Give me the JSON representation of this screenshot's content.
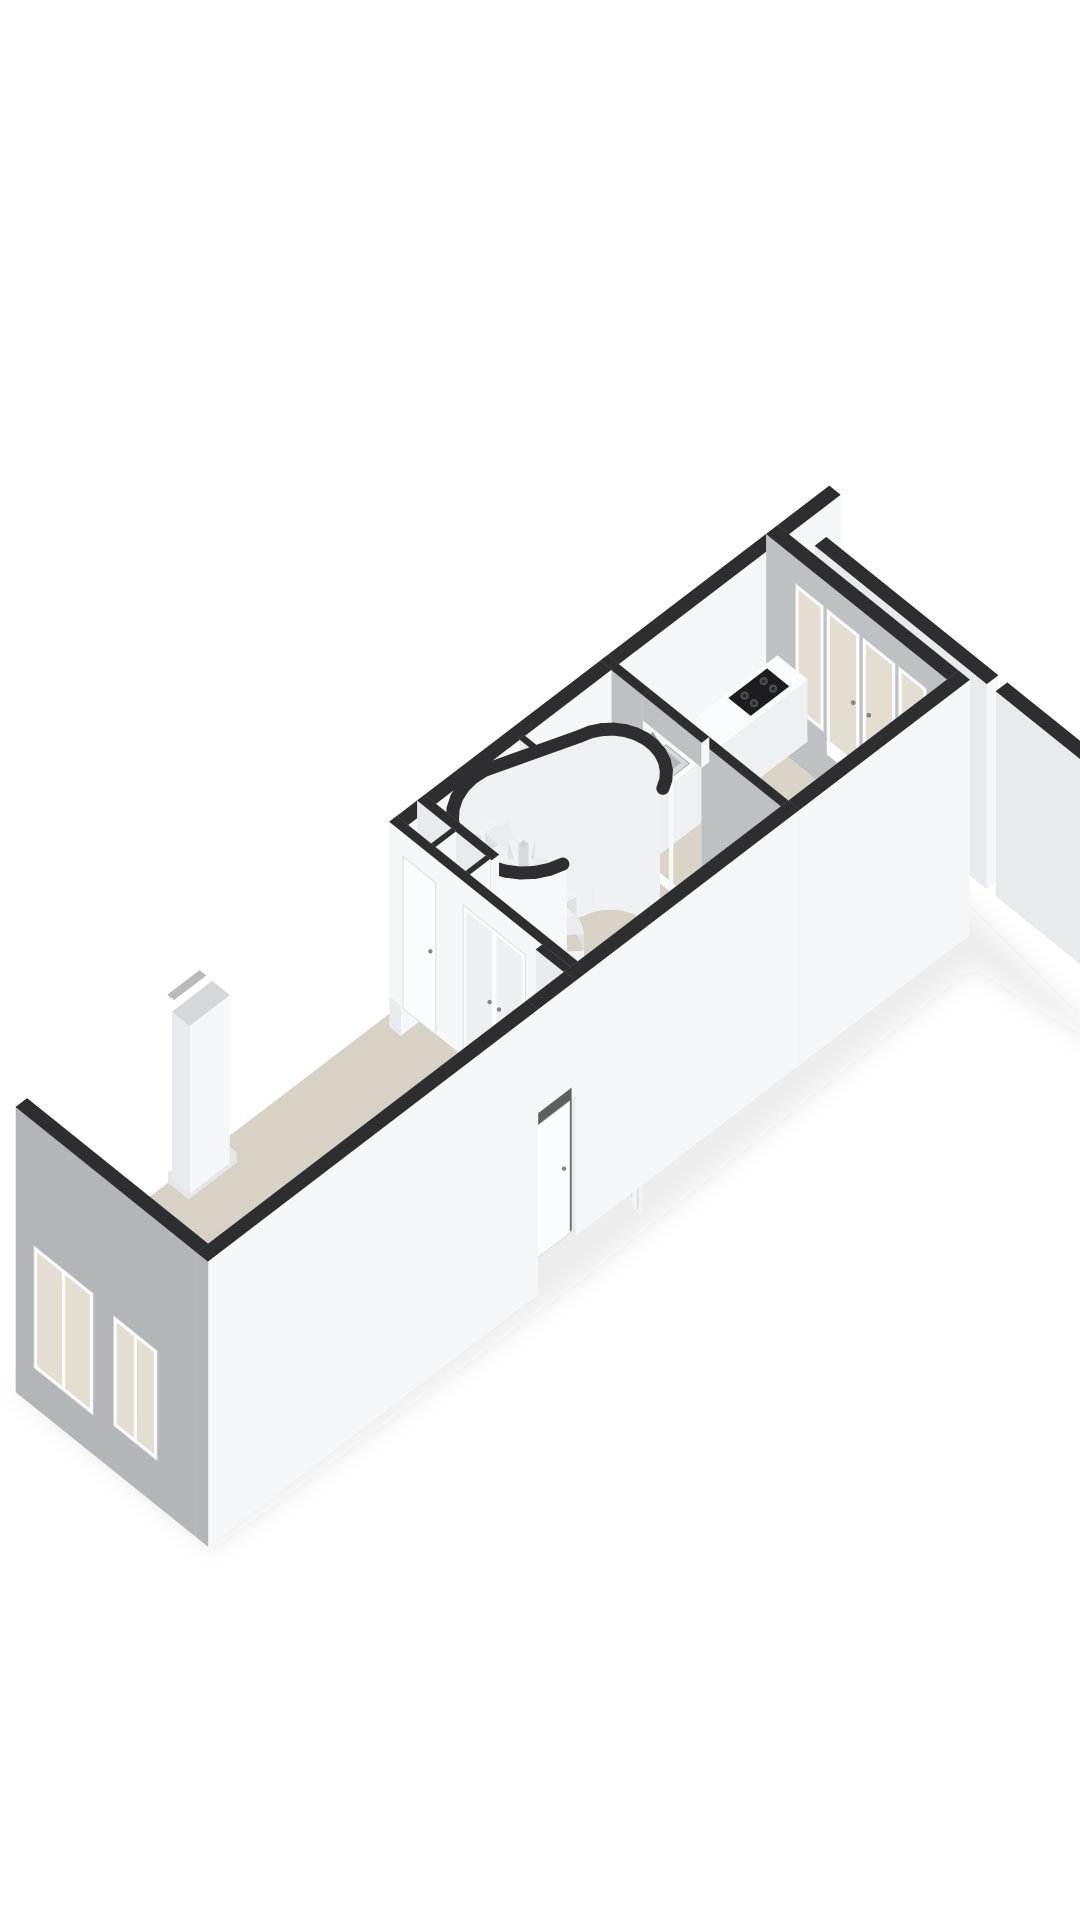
{
  "figure": {
    "kind": "3d-floorplan-render",
    "visible_text": "none"
  },
  "scene": {
    "canvas": {
      "w": 1080,
      "h": 1920
    },
    "projection": {
      "origin": [
        16,
        1282
      ],
      "u": [
        0.795,
        -0.607
      ],
      "v": [
        0.78,
        0.627
      ]
    },
    "palette": {
      "bg": "#ffffff",
      "wallTop": "#2e2e31",
      "wallWhite": "#f6f7f9",
      "wallShade": "#e8eaed",
      "wallGray": "#bec0c4",
      "extGray": "#b4b5b8",
      "floor": "#d8d1c5",
      "floorKitchen": "#dad3c7",
      "floorLight": "#e9e7e2",
      "frame": "#fdfdfe",
      "glassWarm": "#e4ded2",
      "glassCool": "#edeff2",
      "leaf": "#fbfcfd",
      "counterTop": "#fafbfc",
      "counterFace": "#eef0f2",
      "cooktop": "#1d1d20",
      "burner": "#4b4d51",
      "burnerCap": "#232427",
      "steel": "#d7d9dc",
      "steelDeep": "#b3b5b9",
      "slab": "#b9bbbe",
      "void": "#cdcfd3",
      "stepTop": "#eef0f2",
      "stepRiser": "#f9fafb",
      "railWhite": "#f2f3f5",
      "spindle": "#d9dbde",
      "poleSide": "#d8dade",
      "poleTop": "#cfd1d5",
      "capIn": "#eff1f4",
      "capOut": "#f7f8fa",
      "discFloor": "#e6e7ea",
      "recessDark": "#5e5f62",
      "handle": "#85878b",
      "chimTop": "#d6d7d9",
      "plinth": "#e5e6e8",
      "sliver": "#b9babd"
    },
    "capsule": {
      "a": [
        560,
        80
      ],
      "ra": 64,
      "b": [
        652,
        98
      ],
      "rb": 50,
      "t": 6,
      "openX": [
        582,
        670
      ],
      "openYmin": 116,
      "ztop": 175
    },
    "spiral": {
      "c": [
        560,
        80
      ],
      "r": 54,
      "steps": 8,
      "a0": 250,
      "sweep": 25,
      "ztop": 140,
      "drop": 17
    },
    "straightStair": {
      "x": [
        566,
        648
      ],
      "y0": 131,
      "treads": 7,
      "depth": 13.6,
      "rise": 12,
      "ztop": -4
    },
    "balustradeSpec": {
      "x": 560,
      "y": [
        126,
        232
      ],
      "zA": 40,
      "zB": -40,
      "panelDrop": 92,
      "spindleStep": 8
    },
    "elements": [
      {
        "t": "shadow",
        "name": "building-ground-shadow",
        "pts": [
          [
            0,
            0
          ],
          [
            1023,
            0
          ],
          [
            1023,
            20
          ],
          [
            980,
            430
          ],
          [
            958,
            250
          ],
          [
            462,
            262
          ],
          [
            0,
            252
          ]
        ],
        "z": -96,
        "dy": 14,
        "fill": "rgba(40,40,45,0.09)"
      },
      {
        "t": "floor",
        "name": "living-room-floor",
        "rect": [
          14,
          14,
          470,
          232
        ],
        "fill": "floor"
      },
      {
        "t": "floor",
        "name": "hall-floor",
        "rect": [
          470,
          14,
          735,
          232
        ],
        "fill": "floor"
      },
      {
        "t": "floor",
        "name": "hall-closet-floor",
        "rect": [
          470,
          14,
          514,
          95
        ],
        "fill": "floorLight"
      },
      {
        "t": "floor",
        "name": "kitchen-floor",
        "rect": [
          744,
          14,
          944,
          232
        ],
        "fill": "floorKitchen"
      },
      {
        "t": "box",
        "name": "rear-left-exterior-wall-kitchen",
        "rect": [
          735,
          0,
          958,
          14
        ],
        "z": [
          -30,
          175
        ]
      },
      {
        "t": "box",
        "name": "party-wall-stub",
        "rect": [
          958,
          0,
          1023,
          14
        ],
        "z": [
          -30,
          175
        ]
      },
      {
        "t": "box",
        "name": "terrace-wall-upper",
        "rect": [
          966,
          40,
          980,
          260
        ],
        "z": [
          -30,
          175
        ]
      },
      {
        "t": "box",
        "name": "terrace-wall-lower",
        "rect": [
          966,
          272,
          980,
          430
        ],
        "z": [
          -30,
          175
        ]
      },
      {
        "t": "box",
        "name": "kitchen-rear-wall",
        "rect": [
          944,
          0,
          958,
          246
        ],
        "z": [
          -30,
          175
        ],
        "faces": {
          "xm": "wallGray",
          "yp": "wallWhite"
        }
      },
      {
        "t": "panel",
        "kind": "window",
        "name": "kitchen-rear-window-left",
        "plane": "x",
        "at": 943.2,
        "span": [
          38,
          74
        ],
        "z": [
          24,
          150
        ]
      },
      {
        "t": "panel",
        "kind": "glassdoor",
        "name": "kitchen-terrace-door-left",
        "plane": "x",
        "at": 943.2,
        "span": [
          78,
          120
        ],
        "z": [
          4,
          150
        ],
        "handle": "end"
      },
      {
        "t": "panel",
        "kind": "glassdoor",
        "name": "kitchen-terrace-door-right",
        "plane": "x",
        "at": 943.2,
        "span": [
          124,
          166
        ],
        "z": [
          4,
          150
        ],
        "handle": "start"
      },
      {
        "t": "panel",
        "kind": "window",
        "name": "kitchen-rear-window-right",
        "plane": "x",
        "at": 943.2,
        "span": [
          170,
          206
        ],
        "z": [
          24,
          150
        ]
      },
      {
        "t": "box",
        "name": "kitchen-counter",
        "rect": [
          744,
          14,
          944,
          52
        ],
        "z": [
          0,
          62
        ],
        "top": "counterTop",
        "faces": {
          "xm": "counterFace",
          "yp": "counterFace",
          "ym": "counterFace",
          "xp": "counterFace"
        }
      },
      {
        "t": "cooktop",
        "name": "gas-cooktop",
        "rect": [
          878,
          19,
          926,
          47
        ],
        "z": 63
      },
      {
        "t": "sink",
        "name": "kitchen-sink",
        "rect": [
          762,
          18,
          800,
          48
        ],
        "z": 63
      },
      {
        "t": "box",
        "name": "kitchen-partition-wall-upper",
        "rect": [
          735,
          0,
          744,
          55
        ],
        "z": [
          0,
          175
        ],
        "faces": {
          "xm": "wallGray"
        }
      },
      {
        "t": "box",
        "name": "kitchen-partition-wall-lower",
        "rect": [
          735,
          130,
          744,
          232
        ],
        "z": [
          0,
          175
        ],
        "faces": {
          "xm": "wallGray"
        }
      },
      {
        "t": "box",
        "name": "kitchen-doorway-lintel",
        "rect": [
          735,
          55,
          744,
          130
        ],
        "z": [
          150,
          175
        ],
        "faces": {
          "xm": "wallGray"
        }
      },
      {
        "t": "box",
        "name": "rear-left-exterior-wall-hall",
        "rect": [
          470,
          0,
          735,
          14
        ],
        "z": [
          -30,
          175
        ]
      },
      {
        "t": "box",
        "name": "stair-closet-partition",
        "rect": [
          620,
          14,
          626,
          40
        ],
        "z": [
          0,
          175
        ]
      },
      {
        "t": "capsuleIn",
        "name": "spiral-stair-enclosure-inner"
      },
      {
        "t": "spiral",
        "name": "spiral-staircase"
      },
      {
        "t": "capsuleOut",
        "name": "spiral-stair-enclosure-outer"
      },
      {
        "t": "floor",
        "name": "stairwell-void",
        "rect": [
          566,
          130,
          648,
          232
        ],
        "fill": "void"
      },
      {
        "t": "panel",
        "kind": "slab",
        "name": "stairwell-slab-edge-right",
        "plane": "x",
        "at": 648,
        "span": [
          130,
          232
        ],
        "z": [
          -20,
          0
        ],
        "fill": "slab"
      },
      {
        "t": "panel",
        "kind": "slab",
        "name": "stairwell-slab-edge-top",
        "plane": "y",
        "at": 130,
        "span": [
          566,
          648
        ],
        "z": [
          -20,
          0
        ],
        "fill": "#c6c8cb"
      },
      {
        "t": "stair",
        "name": "straight-staircase"
      },
      {
        "t": "balustrade",
        "name": "stair-balustrade"
      },
      {
        "t": "box",
        "name": "hall-closet-back-wall",
        "rect": [
          505,
          0,
          514,
          95
        ],
        "z": [
          0,
          175
        ]
      },
      {
        "t": "box",
        "name": "hall-closet-partition-1",
        "rect": [
          474,
          44,
          505,
          49
        ],
        "z": [
          0,
          175
        ]
      },
      {
        "t": "box",
        "name": "hall-closet-partition-2",
        "rect": [
          474,
          88,
          505,
          93
        ],
        "z": [
          0,
          175
        ]
      },
      {
        "t": "box",
        "name": "living-hall-wall",
        "rect": [
          470,
          0,
          479,
          232
        ],
        "z": [
          0,
          175
        ],
        "faces": {
          "xm": "wallWhite"
        }
      },
      {
        "t": "panel",
        "kind": "door",
        "name": "living-room-door",
        "plane": "x",
        "at": 469.2,
        "span": [
          18,
          60
        ],
        "z": [
          0,
          152
        ]
      },
      {
        "t": "panel",
        "kind": "glassdouble",
        "name": "hall-glass-double-doors",
        "plane": "x",
        "at": 469.2,
        "span": [
          95,
          175
        ],
        "z": [
          0,
          152
        ]
      },
      {
        "t": "box",
        "name": "entry-stub-wall",
        "rect": [
          462,
          196,
          470,
          232
        ],
        "z": [
          0,
          175
        ]
      },
      {
        "t": "box",
        "name": "chimney-plinth",
        "rect": [
          178,
          14,
          238,
          40
        ],
        "z": [
          0,
          10
        ],
        "top": "plinth",
        "faces": {
          "xm": "plinth",
          "yp": "plinth"
        }
      },
      {
        "t": "box",
        "name": "chimney-breast",
        "rect": [
          183,
          14,
          233,
          36
        ],
        "z": [
          0,
          168
        ],
        "top": "chimTop"
      },
      {
        "t": "flat",
        "name": "chimney-wall-recess",
        "rect": [
          188,
          3,
          228,
          11
        ],
        "z": 175,
        "fill": "sliver"
      },
      {
        "t": "box",
        "name": "front-facade-wall",
        "rect": [
          0,
          0,
          14,
          246
        ],
        "z": [
          -110,
          175
        ],
        "faces": {
          "xm": "extGray"
        }
      },
      {
        "t": "panel",
        "kind": "window",
        "name": "front-window-left",
        "plane": "x",
        "at": -1,
        "span": [
          24,
          100
        ],
        "z": [
          -70,
          52
        ],
        "panes": 2
      },
      {
        "t": "panel",
        "kind": "window",
        "name": "front-window-right",
        "plane": "x",
        "at": -1,
        "span": [
          126,
          182
        ],
        "z": [
          -64,
          46
        ],
        "panes": 2
      },
      {
        "t": "box",
        "name": "front-right-exterior-wall-kitchen",
        "rect": [
          744,
          232,
          958,
          246
        ],
        "z": [
          -80,
          175
        ]
      },
      {
        "t": "box",
        "name": "front-right-exterior-wall-hall",
        "rect": [
          462,
          232,
          744,
          246
        ],
        "z": [
          -80,
          175
        ]
      },
      {
        "t": "box",
        "name": "entry-lintel",
        "rect": [
          415,
          232,
          462,
          246
        ],
        "z": [
          60,
          175
        ]
      },
      {
        "t": "panel",
        "kind": "dark",
        "name": "entry-recess",
        "plane": "y",
        "at": 239,
        "span": [
          413,
          464
        ],
        "z": [
          -80,
          62
        ],
        "fill": "recessDark"
      },
      {
        "t": "panel",
        "kind": "door",
        "name": "entry-door",
        "plane": "y",
        "at": 242,
        "span": [
          418,
          459
        ],
        "z": [
          -78,
          54
        ]
      },
      {
        "t": "box",
        "name": "front-right-exterior-wall-living",
        "rect": [
          0,
          232,
          415,
          246
        ],
        "z": [
          -110,
          175
        ],
        "faces": {
          "xm": "extGray"
        }
      }
    ]
  }
}
